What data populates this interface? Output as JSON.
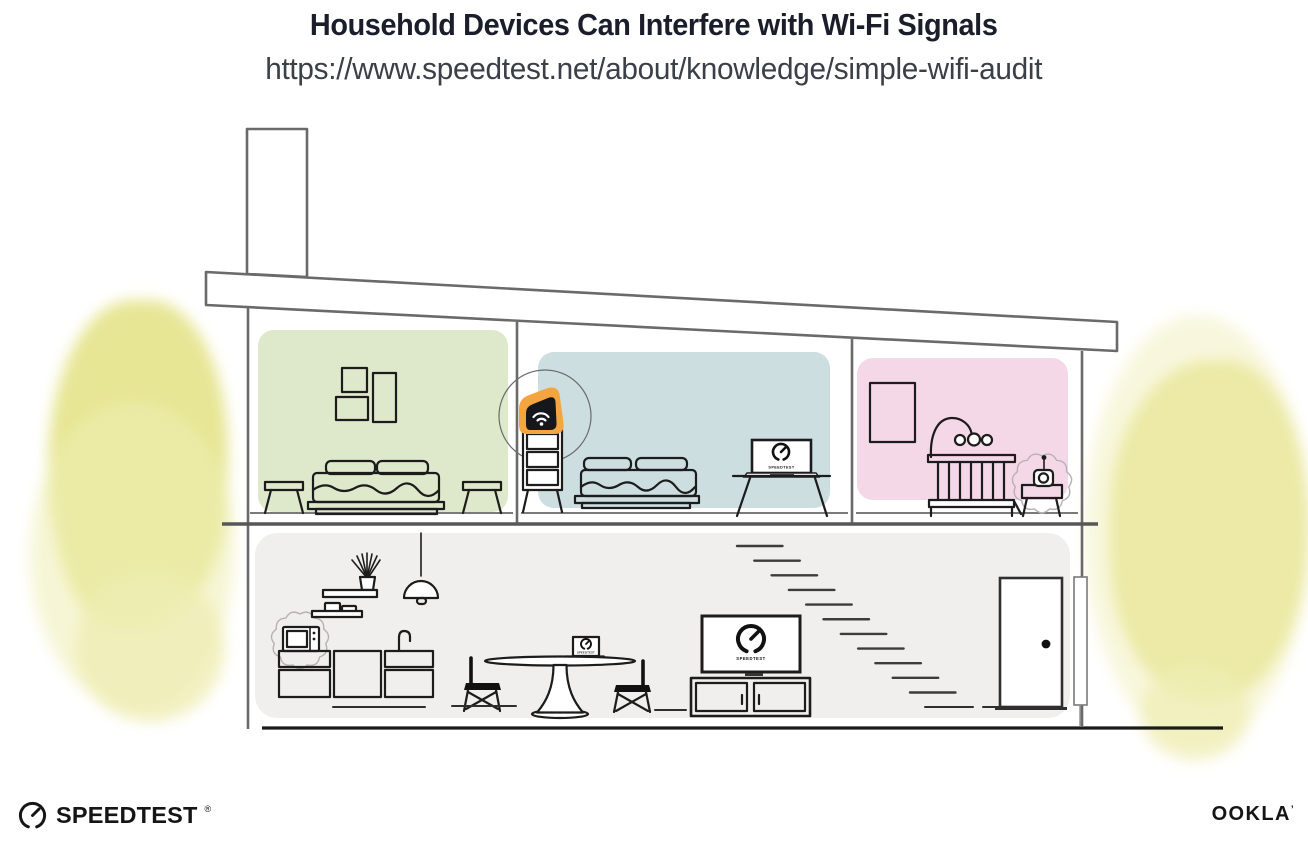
{
  "header": {
    "title": "Household Devices Can Interfere with Wi-Fi Signals",
    "url": "https://www.speedtest.net/about/knowledge/simple-wifi-audit"
  },
  "screens": {
    "bedroom_laptop_label": "SPEEDTEST",
    "dining_laptop_label": "SPEEDTEST",
    "living_tv_label": "SPEEDTEST"
  },
  "footer": {
    "speedtest_wordmark": "SPEEDTEST",
    "speedtest_reg": "®",
    "ookla_wordmark": "OOKLA",
    "ookla_reg": "’"
  },
  "colors": {
    "room_green": "#dee8ca",
    "room_blue": "#cddee1",
    "room_pink": "#f5d8e7",
    "room_gray": "#f0efed",
    "accent_orange": "#f4a53f",
    "foliage_yellow": "#e3e282",
    "foliage_light": "#efeeb4",
    "structure_gray": "#6a6a6a",
    "ink": "#1c1c1c"
  },
  "icons": {
    "router": "wifi-router-icon",
    "microwave": "microwave-icon",
    "baby_monitor": "baby-monitor-icon",
    "gauge": "speedtest-gauge-icon"
  }
}
